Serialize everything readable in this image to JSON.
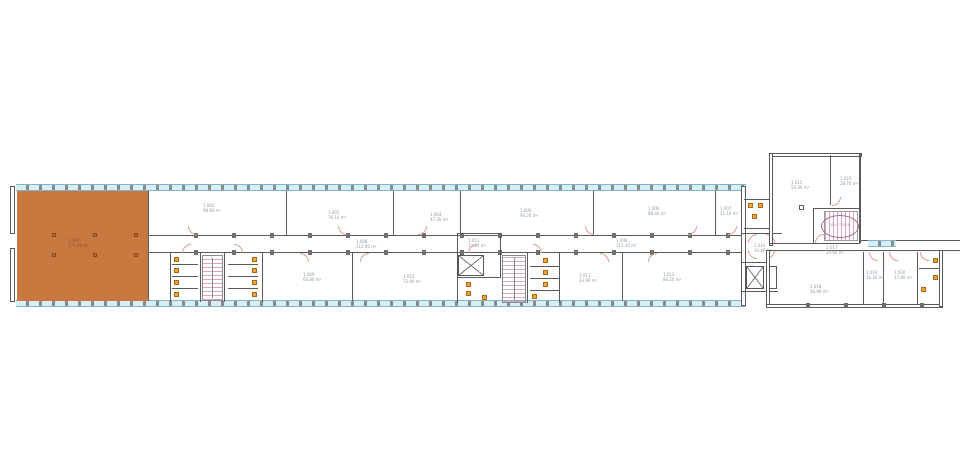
{
  "colors": {
    "wall": "#5a5a5a",
    "window_fill": "#d9edf4",
    "window_frame": "#7ab6ce",
    "highlight_room": "#c9783f",
    "fixture": "#f2a13c",
    "stair_hatch": "#d9a6c2",
    "door_swing": "#dba091",
    "label_text": "#8f9dab"
  },
  "highlighted_room": {
    "no": "1.001",
    "area": "276.80 m²"
  },
  "corridor": {
    "no": "1.008",
    "area": "112.40 m²"
  },
  "rooms": {
    "t1": {
      "no": "1.002",
      "area": "98.60 m²"
    },
    "t2": {
      "no": "1.003",
      "area": "76.10 m²"
    },
    "t3": {
      "no": "1.004",
      "area": "47.30 m²"
    },
    "t4": {
      "no": "1.005",
      "area": "94.20 m²"
    },
    "t5": {
      "no": "1.006",
      "area": "88.40 m²"
    },
    "t6": {
      "no": "1.007",
      "area": "21.10 m²"
    },
    "b1": {
      "no": "1.009",
      "area": "64.80 m²"
    },
    "b2": {
      "no": "1.010",
      "area": "72.60 m²"
    },
    "b3": {
      "no": "1.011",
      "area": "33.90 m²"
    },
    "b4": {
      "no": "1.012",
      "area": "86.20 m²"
    },
    "cb_top": {
      "no": "1.013",
      "area": "12.80 m²"
    },
    "lobby": {
      "no": "1.014",
      "area": "16.40 m²"
    },
    "w_up_l": {
      "no": "1.015",
      "area": "54.30 m²"
    },
    "w_up_r": {
      "no": "1.016",
      "area": "28.70 m²"
    },
    "w_corr": {
      "no": "1.017",
      "area": "24.60 m²"
    },
    "w_big": {
      "no": "1.018",
      "area": "56.90 m²"
    },
    "w_s1": {
      "no": "1.019",
      "area": "16.20 m²"
    },
    "w_s2": {
      "no": "1.020",
      "area": "17.80 m²"
    }
  },
  "stairs": {
    "wing_label": "18x17.5/28",
    "main_label": "18 STG"
  }
}
